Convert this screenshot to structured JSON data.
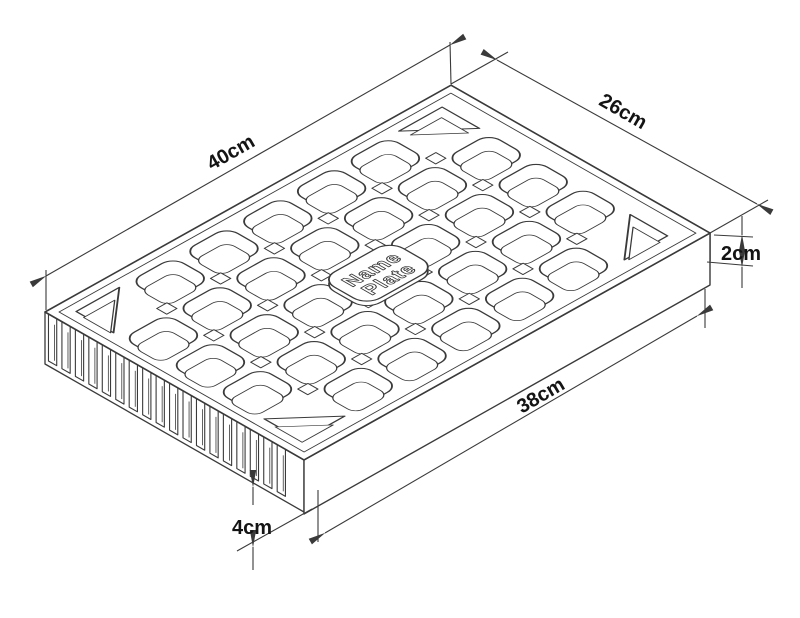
{
  "diagram": {
    "title_hidden": "",
    "background": "#ffffff",
    "line_color": "#3a3a3a",
    "text_color": "#141414",
    "dimensions": {
      "length": {
        "label": "40cm"
      },
      "width": {
        "label": "26cm"
      },
      "rim": {
        "label": "2cm"
      },
      "inner_length": {
        "label": "38cm"
      },
      "wall": {
        "label": "4cm"
      }
    },
    "name_plate": {
      "line1": "Name",
      "line2": "Plate"
    },
    "grid": {
      "cols": 7,
      "rows": 5,
      "teeth": 13,
      "slats": 18,
      "post_cols": 6,
      "post_rows": 4
    }
  }
}
